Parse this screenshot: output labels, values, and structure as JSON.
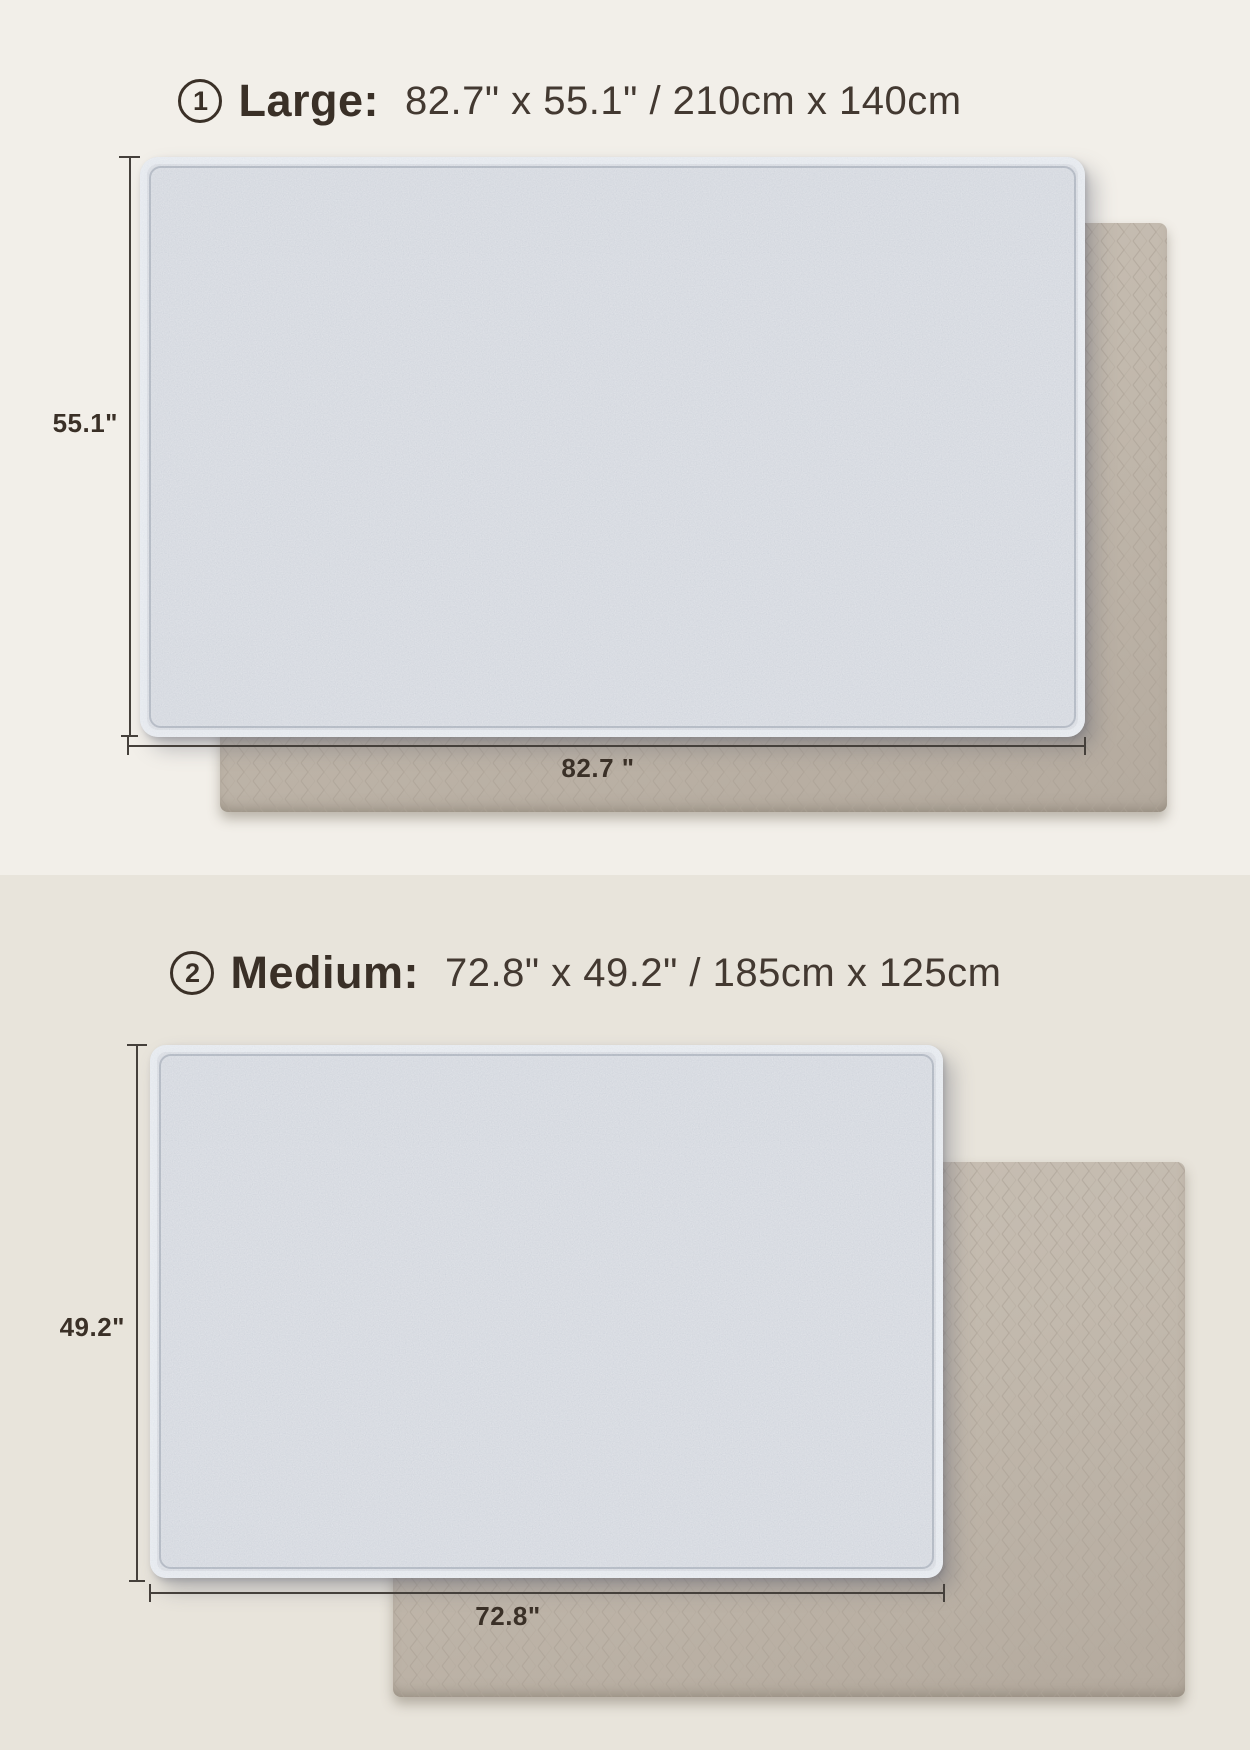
{
  "sections": [
    {
      "number": "1",
      "name": "Large:",
      "size": "82.7\" x 55.1\" / 210cm x 140cm",
      "height_label": "55.1\"",
      "width_label": "82.7 \""
    },
    {
      "number": "2",
      "name": "Medium:",
      "size": "72.8\" x 49.2\" / 185cm x 125cm",
      "height_label": "49.2\"",
      "width_label": "72.8\""
    }
  ],
  "colors": {
    "background_top": "#F2EFE9",
    "background_bottom": "#E8E4DB",
    "mat_front_blue": "#C8CDD6",
    "mat_back_beige": "#C2B9AD",
    "text": "#3A3027",
    "dimension_line": "#45403B"
  }
}
